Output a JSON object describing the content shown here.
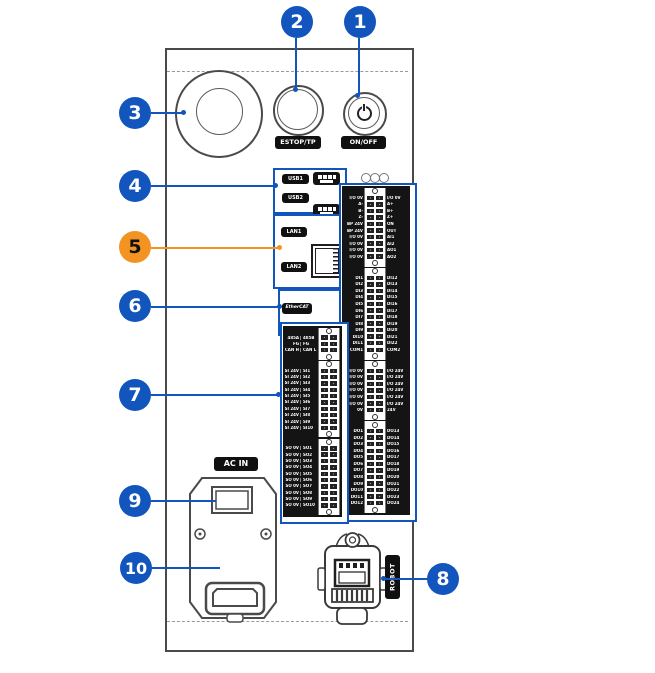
{
  "callouts": [
    {
      "num": "1"
    },
    {
      "num": "2"
    },
    {
      "num": "3"
    },
    {
      "num": "4"
    },
    {
      "num": "5"
    },
    {
      "num": "6"
    },
    {
      "num": "7"
    },
    {
      "num": "8"
    },
    {
      "num": "9"
    },
    {
      "num": "10"
    }
  ],
  "labels": {
    "usb1": "USB1",
    "usb2": "USB2",
    "lan1": "LAN1",
    "lan2": "LAN2",
    "ethercat": "EtherCAT",
    "estop": "ESTOP/TP",
    "onoff": "ON/OFF",
    "ac_in": "AC IN",
    "robot": "ROBOT"
  },
  "colors": {
    "callout_blue": "#1155bd",
    "callout_orange": "#f39322",
    "line_art": "#3a3a3a",
    "panel_black": "#141414"
  },
  "left_block": {
    "groups": [
      {
        "name": "comm",
        "rows": [
          [
            "485A",
            "485B"
          ],
          [
            "FG",
            "FG"
          ],
          [
            "CAN H",
            "CAN L"
          ]
        ]
      },
      {
        "name": "safety-in",
        "rows": [
          [
            "SI 24V",
            "SI1"
          ],
          [
            "SI 24V",
            "SI2"
          ],
          [
            "SI 24V",
            "SI3"
          ],
          [
            "SI 24V",
            "SI4"
          ],
          [
            "SI 24V",
            "SI5"
          ],
          [
            "SI 24V",
            "SI6"
          ],
          [
            "SI 24V",
            "SI7"
          ],
          [
            "SI 24V",
            "SI8"
          ],
          [
            "SI 24V",
            "SI9"
          ],
          [
            "SI 24V",
            "SI10"
          ]
        ]
      },
      {
        "name": "safety-out",
        "rows": [
          [
            "SO 0V",
            "SO1"
          ],
          [
            "SO 0V",
            "SO2"
          ],
          [
            "SO 0V",
            "SO3"
          ],
          [
            "SO 0V",
            "SO4"
          ],
          [
            "SO 0V",
            "SO5"
          ],
          [
            "SO 0V",
            "SO6"
          ],
          [
            "SO 0V",
            "SO7"
          ],
          [
            "SO 0V",
            "SO8"
          ],
          [
            "SO 0V",
            "SO9"
          ],
          [
            "SO 0V",
            "SO10"
          ]
        ]
      }
    ]
  },
  "right_block": {
    "groups": [
      {
        "name": "encoder-analog",
        "rows": [
          [
            "I/O 0V",
            "I/O 0V"
          ],
          [
            "A-",
            "A+"
          ],
          [
            "B-",
            "B+"
          ],
          [
            "Z-",
            "Z+"
          ],
          [
            "BP 24V",
            "ON"
          ],
          [
            "BP 24V",
            "OUT"
          ],
          [
            "I/O 0V",
            "AI1"
          ],
          [
            "I/O 0V",
            "AI2"
          ],
          [
            "I/O 0V",
            "AO1"
          ],
          [
            "I/O 0V",
            "AO2"
          ]
        ]
      },
      {
        "name": "digital-in",
        "rows": [
          [
            "DI1",
            "DI12"
          ],
          [
            "DI2",
            "DI13"
          ],
          [
            "DI3",
            "DI14"
          ],
          [
            "DI4",
            "DI15"
          ],
          [
            "DI5",
            "DI16"
          ],
          [
            "DI6",
            "DI17"
          ],
          [
            "DI7",
            "DI18"
          ],
          [
            "DI8",
            "DI19"
          ],
          [
            "DI9",
            "DI20"
          ],
          [
            "DI10",
            "DI21"
          ],
          [
            "DI11",
            "DI22"
          ],
          [
            "COM1",
            "COM2"
          ]
        ]
      },
      {
        "name": "power-rail",
        "rows": [
          [
            "I/O 0V",
            "I/O 24V"
          ],
          [
            "I/O 0V",
            "I/O 24V"
          ],
          [
            "I/O 0V",
            "I/O 24V"
          ],
          [
            "I/O 0V",
            "I/O 24V"
          ],
          [
            "I/O 0V",
            "I/O 24V"
          ],
          [
            "I/O 0V",
            "I/O 24V"
          ],
          [
            "0V",
            "24V"
          ]
        ]
      },
      {
        "name": "digital-out",
        "rows": [
          [
            "DO1",
            "DO13"
          ],
          [
            "DO2",
            "DO14"
          ],
          [
            "DO3",
            "DO15"
          ],
          [
            "DO4",
            "DO16"
          ],
          [
            "DO5",
            "DO17"
          ],
          [
            "DO6",
            "DO18"
          ],
          [
            "DO7",
            "DO19"
          ],
          [
            "DO8",
            "DO20"
          ],
          [
            "DO9",
            "DO21"
          ],
          [
            "DO10",
            "DO22"
          ],
          [
            "DO11",
            "DO23"
          ],
          [
            "DO12",
            "DO24"
          ]
        ]
      }
    ]
  }
}
